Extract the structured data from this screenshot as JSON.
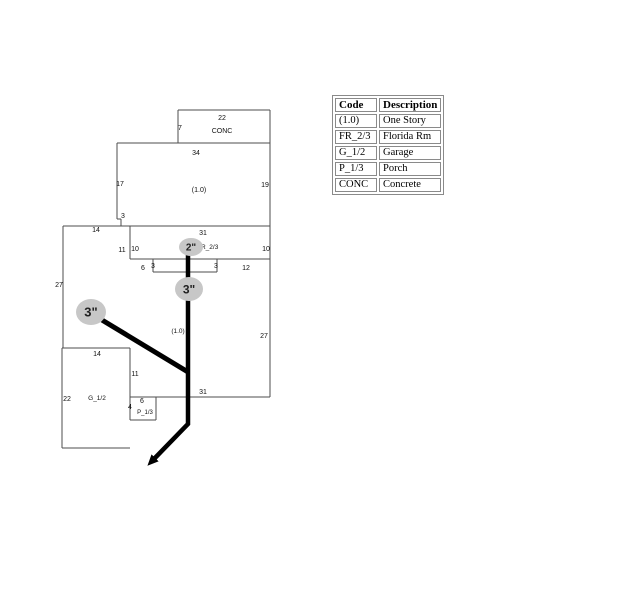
{
  "legend": {
    "headers": [
      "Code",
      "Description"
    ],
    "rows": [
      [
        "(1.0)",
        "One Story"
      ],
      [
        "FR_2/3",
        "Florida Rm"
      ],
      [
        "G_1/2",
        "Garage"
      ],
      [
        "P_1/3",
        "Porch"
      ],
      [
        "CONC",
        "Concrete"
      ]
    ]
  },
  "sketch": {
    "outline_color": "#4d4d4d",
    "pipe_color": "#000000",
    "node_fill": "#c7c7c7",
    "label_color": "#111111",
    "segments": [
      [
        178,
        110,
        270,
        110
      ],
      [
        178,
        110,
        178,
        143
      ],
      [
        270,
        110,
        270,
        397
      ],
      [
        117,
        143,
        270,
        143
      ],
      [
        117,
        143,
        117,
        219
      ],
      [
        117,
        219,
        121,
        219
      ],
      [
        121,
        219,
        121,
        226
      ],
      [
        63,
        226,
        270,
        226
      ],
      [
        63,
        226,
        63,
        348
      ],
      [
        130,
        226,
        130,
        259
      ],
      [
        130,
        259,
        270,
        259
      ],
      [
        153,
        259,
        153,
        272
      ],
      [
        153,
        272,
        217,
        272
      ],
      [
        217,
        259,
        217,
        272
      ],
      [
        62,
        348,
        130,
        348
      ],
      [
        62,
        348,
        62,
        448
      ],
      [
        62,
        448,
        130,
        448
      ],
      [
        130,
        348,
        130,
        420
      ],
      [
        130,
        397,
        270,
        397
      ],
      [
        156,
        397,
        156,
        420
      ],
      [
        130,
        420,
        156,
        420
      ]
    ],
    "dim_labels": [
      {
        "text": "22",
        "x": 222,
        "y": 120
      },
      {
        "text": "7",
        "x": 180,
        "y": 130
      },
      {
        "text": "34",
        "x": 196,
        "y": 155
      },
      {
        "text": "17",
        "x": 120,
        "y": 186
      },
      {
        "text": "19",
        "x": 265,
        "y": 187
      },
      {
        "text": "3",
        "x": 123,
        "y": 218
      },
      {
        "text": "14",
        "x": 96,
        "y": 232
      },
      {
        "text": "31",
        "x": 203,
        "y": 235
      },
      {
        "text": "11",
        "x": 122,
        "y": 252
      },
      {
        "text": "10",
        "x": 135,
        "y": 251
      },
      {
        "text": "6",
        "x": 143,
        "y": 270
      },
      {
        "text": "3",
        "x": 153,
        "y": 268
      },
      {
        "text": "3",
        "x": 216,
        "y": 268
      },
      {
        "text": "12",
        "x": 246,
        "y": 270
      },
      {
        "text": "10",
        "x": 266,
        "y": 251
      },
      {
        "text": "27",
        "x": 59,
        "y": 287
      },
      {
        "text": "27",
        "x": 264,
        "y": 338
      },
      {
        "text": "14",
        "x": 97,
        "y": 356
      },
      {
        "text": "11",
        "x": 135,
        "y": 376
      },
      {
        "text": "22",
        "x": 67,
        "y": 401
      },
      {
        "text": "31",
        "x": 203,
        "y": 394
      },
      {
        "text": "6",
        "x": 142,
        "y": 403
      },
      {
        "text": "4",
        "x": 130,
        "y": 409
      }
    ],
    "area_labels": [
      {
        "text": "CONC",
        "x": 222,
        "y": 133
      },
      {
        "text": "(1.0)",
        "x": 199,
        "y": 192
      },
      {
        "text": "FR_2/3",
        "x": 197,
        "y": 249,
        "anchor": "start",
        "fs": 6.5
      },
      {
        "text": "(1.0)",
        "x": 178,
        "y": 333,
        "fs": 6.5
      },
      {
        "text": "G_1/2",
        "x": 97,
        "y": 400,
        "fs": 6.5
      },
      {
        "text": "P_1/3",
        "x": 145,
        "y": 414,
        "fs": 6
      }
    ],
    "pipes": [
      {
        "points": [
          [
            188,
            250
          ],
          [
            188,
            424
          ],
          [
            153,
            460
          ]
        ],
        "width": 4.5,
        "arrow": true
      },
      {
        "points": [
          [
            102,
            320
          ],
          [
            188,
            372
          ]
        ],
        "width": 5,
        "arrow": false
      }
    ],
    "nodes": [
      {
        "label": "2\"",
        "x": 191,
        "y": 247,
        "rx": 12,
        "ry": 9,
        "fs": 10
      },
      {
        "label": "3\"",
        "x": 189,
        "y": 289,
        "rx": 14,
        "ry": 12,
        "fs": 12
      },
      {
        "label": "3\"",
        "x": 91,
        "y": 312,
        "rx": 15,
        "ry": 13,
        "fs": 13
      }
    ]
  }
}
